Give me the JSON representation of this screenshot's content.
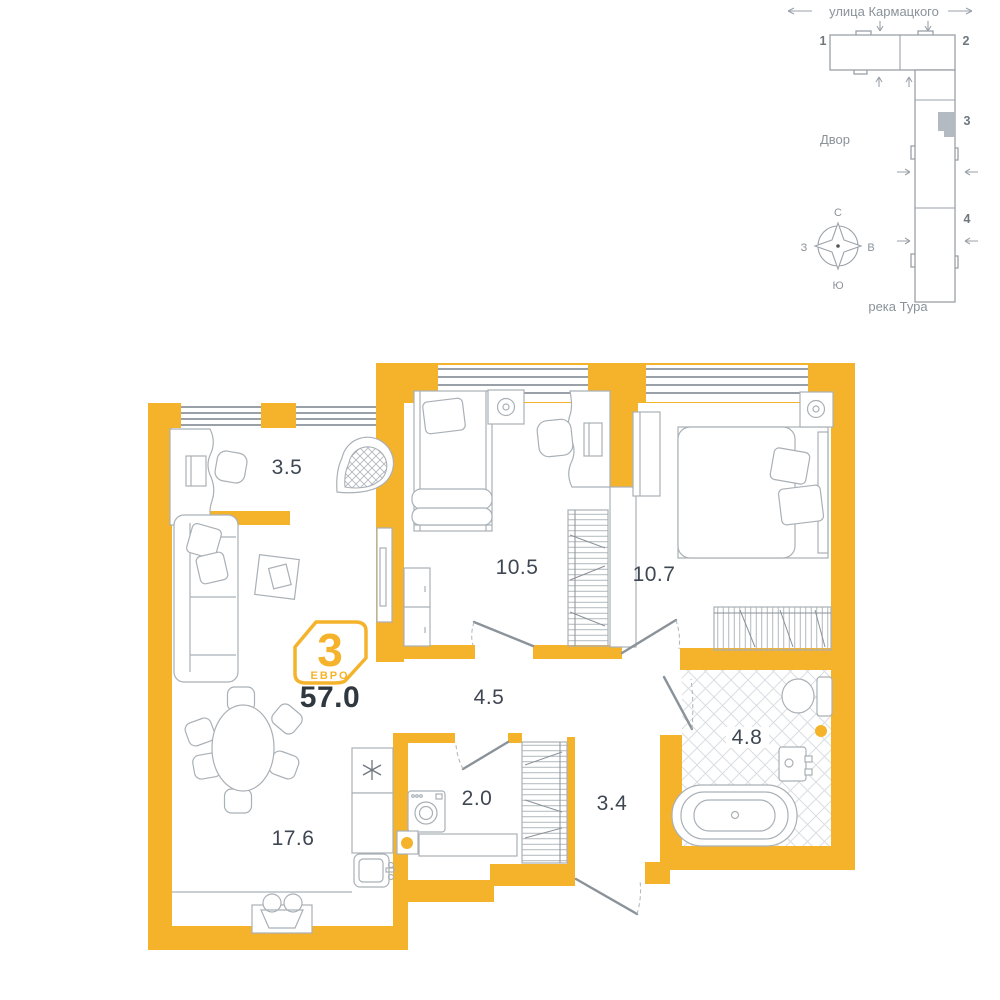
{
  "plan": {
    "badge": {
      "rooms_number": "3",
      "type_label": "ЕВРО"
    },
    "total_area": "57.0",
    "rooms": [
      {
        "id": "loggia",
        "area": "3.5"
      },
      {
        "id": "bedroom-1",
        "area": "10.5"
      },
      {
        "id": "bedroom-2",
        "area": "10.7"
      },
      {
        "id": "hallway",
        "area": "4.5"
      },
      {
        "id": "laundry",
        "area": "2.0"
      },
      {
        "id": "corridor",
        "area": "3.4"
      },
      {
        "id": "bathroom",
        "area": "4.8"
      },
      {
        "id": "kitchen-living",
        "area": "17.6"
      }
    ]
  },
  "site_plan": {
    "street_label": "улица Кармацкого",
    "courtyard_label": "Двор",
    "river_label": "река Тура",
    "building_numbers": [
      "1",
      "2",
      "3",
      "4"
    ],
    "compass": {
      "north": "С",
      "east": "В",
      "south": "Ю",
      "west": "З"
    }
  },
  "colors": {
    "wall": "#F5B32B",
    "furniture_line": "#A9B0B6",
    "label_text": "#3E4752",
    "total_text": "#30383F",
    "site_line": "#9AA1A8",
    "site_text": "#8A929A",
    "building_highlight": "#B3BAC1"
  }
}
